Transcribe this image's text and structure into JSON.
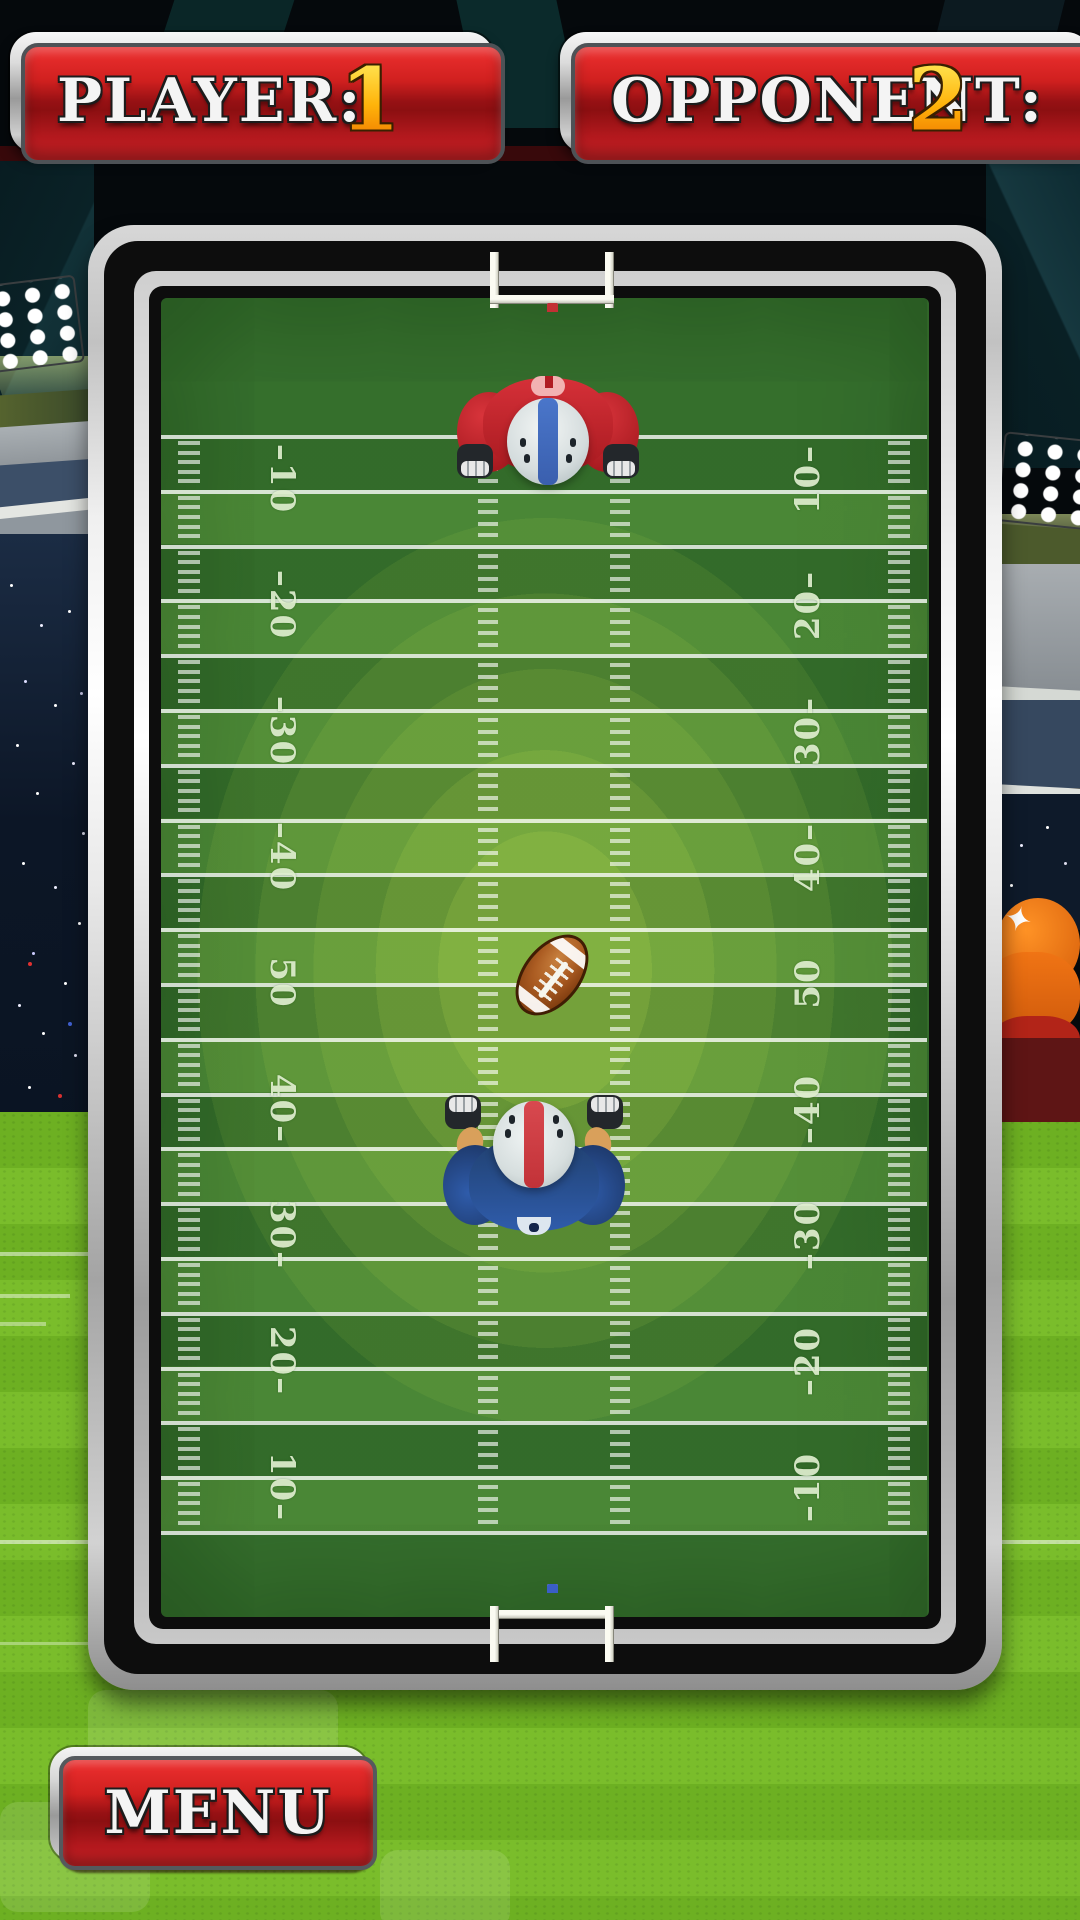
{
  "scoreboard": {
    "player": {
      "label": "PLAYER:",
      "score": "1"
    },
    "opponent": {
      "label": "OPPONENT:",
      "score": "2"
    }
  },
  "menu": {
    "label": "MENU"
  },
  "field": {
    "yard_numbers": [
      "10",
      "20",
      "30",
      "40",
      "50",
      "40",
      "30",
      "20",
      "10"
    ],
    "dash": "–"
  },
  "colors": {
    "panel_red": "#c4161c",
    "score_yellow": "#ffb607",
    "frame_silver": "#e9e9e9",
    "field_green_dark": "#3d7a33",
    "field_green_light": "#8cc63e",
    "team_top_jersey": "#c6252c",
    "team_top_helmet_stripe": "#4a76ca",
    "team_bottom_jersey": "#2b4c8e",
    "team_bottom_helmet_stripe": "#d8494f",
    "ball_brown": "#8f4716",
    "grass": "#6db022"
  }
}
